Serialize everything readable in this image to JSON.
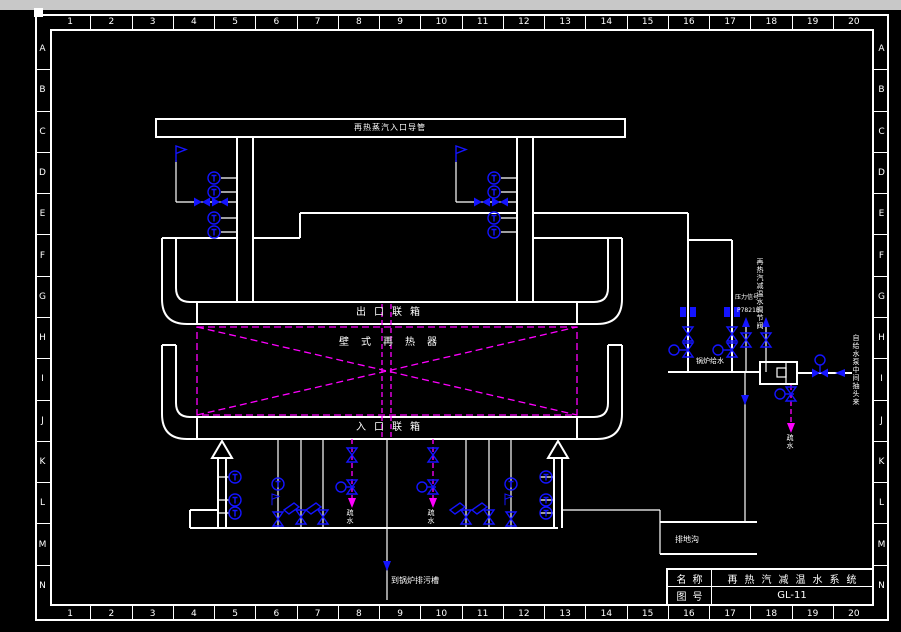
{
  "grid": {
    "cols": [
      "1",
      "2",
      "3",
      "4",
      "5",
      "6",
      "7",
      "8",
      "9",
      "10",
      "11",
      "12",
      "13",
      "14",
      "15",
      "16",
      "17",
      "18",
      "19",
      "20"
    ],
    "rows": [
      "A",
      "B",
      "C",
      "D",
      "E",
      "F",
      "G",
      "H",
      "I",
      "J",
      "K",
      "L",
      "M",
      "N"
    ]
  },
  "title_block": {
    "name_label": "名称",
    "name_value": "再热汽减温水系统",
    "no_label": "图号",
    "no_value": "GL-11"
  },
  "labels": {
    "top_pipe": "再热蒸汽入口导管",
    "outlet_header": "出口联箱",
    "wall_reheater": "壁式再热器",
    "inlet_header": "入口联箱",
    "boiler_feedwater": "锅炉给水",
    "pressure_signal": "压力信号",
    "valve_tag": "P7821B",
    "spray_water_line": "再热汽减温水调节阀",
    "from_feed_pump": "自给水泵中间抽头来",
    "drain_right": "疏水",
    "drain_left_1": "疏水",
    "drain_left_2": "疏水",
    "to_blowdown_tank": "到锅炉排污槽",
    "drain_ditch": "排地沟"
  },
  "icons": {
    "gauge": "round instrument gauge",
    "valve_h": "horizontal bowtie valve",
    "valve_v": "vertical hourglass valve",
    "gate_valve": "flanged gate valve",
    "actuator": "valve actuator circle",
    "flag": "instrument flag",
    "sample_tag": "tilted tag plate",
    "flow_arrow": "flow direction arrow"
  },
  "colors": {
    "background": "#000000",
    "line": "#ffffff",
    "instrument": "#1414ff",
    "spray": "#ff00ff",
    "titlebar": "#c8c8c8"
  }
}
